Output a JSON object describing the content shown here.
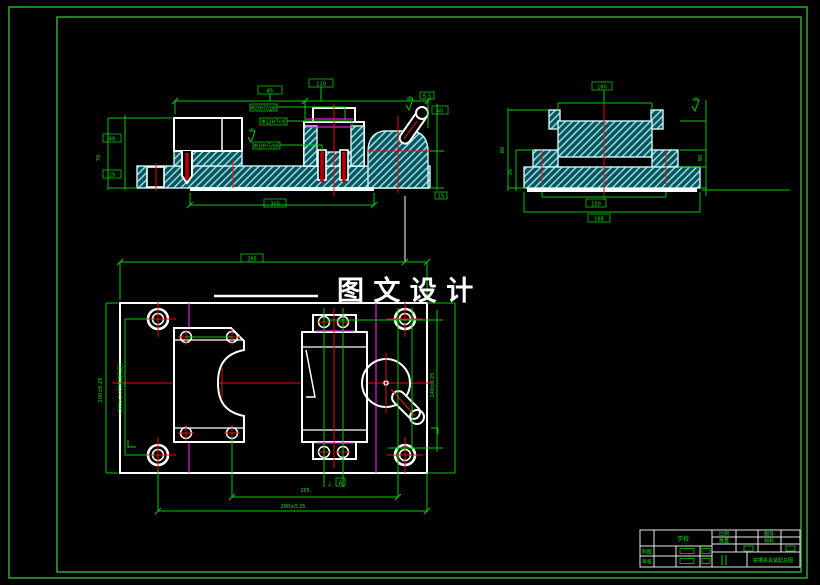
{
  "watermark": {
    "text": "图 文 设 计"
  },
  "colors": {
    "background": "#000000",
    "frame_green": "#2f9e2f",
    "dimension_green": "#00c800",
    "text_green": "#00e400",
    "outline_white": "#ffffff",
    "hatch_fill_teal": "#0a545c",
    "hatch_line_cyan": "#9fe3ea",
    "centerline_red": "#e01010",
    "phantom_magenta": "#e020e0"
  },
  "views": {
    "front": {
      "dims": {
        "top_left": "85",
        "top_right": "120",
        "left_upper": "60",
        "left_lower": "25",
        "left_outer": "70",
        "bottom": "310",
        "right": "40",
        "right_small": "15"
      },
      "callouts": [
        "Φ20H7/g6",
        "Φ12H7/r6",
        "Φ10H7/n6"
      ],
      "roughness": "6.3"
    },
    "side": {
      "dims": {
        "top": "160",
        "left_outer": "80",
        "left_inner": "35",
        "right": "90",
        "bottom_inner": "150",
        "bottom_outer": "188"
      }
    },
    "plan": {
      "dims": {
        "top": "285",
        "left_outer": "200±0.25",
        "left_inner": "160±0.02(两销孔距)",
        "right": "140±0.25",
        "bottom_inner": "255",
        "bottom_outer": "300±0.25"
      },
      "datum": "A"
    }
  },
  "title_block": {
    "school": "学校",
    "drawing_title": "铣槽夹具装配总图",
    "labels": {
      "draw": "制图",
      "check": "审核",
      "scale": "比例",
      "qty": "数量",
      "material": "材料",
      "drawing_no": "图号"
    }
  }
}
